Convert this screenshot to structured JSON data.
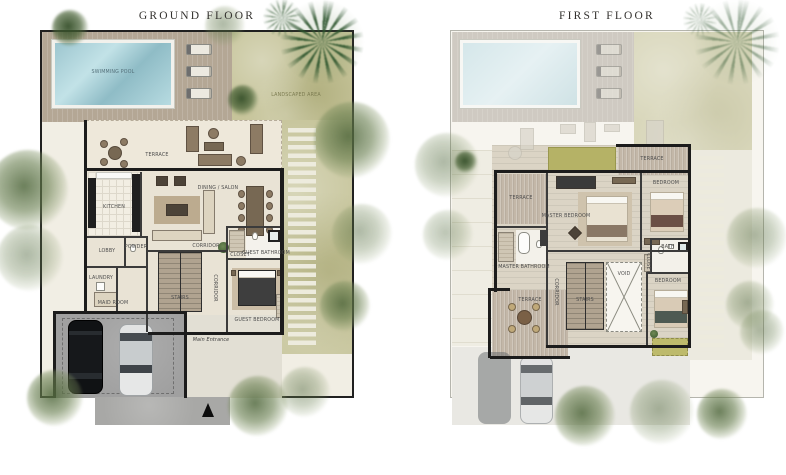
{
  "sheet": {
    "background": "#ffffff"
  },
  "plans": [
    {
      "title": "GROUND FLOOR",
      "labels": {
        "pool": "SWIMMING POOL",
        "landscaped": "LANDSCAPED AREA",
        "terrace": "TERRACE",
        "dining_salon": "DINING / SALON",
        "kitchen": "KITCHEN",
        "lobby": "LOBBY",
        "powder": "POWDER",
        "laundry": "LAUNDRY",
        "maid_room": "MAID ROOM",
        "corridor_a": "CORRIDOR",
        "corridor_b": "CORRIDOR",
        "stairs": "STAIRS",
        "closet": "CLOSET",
        "guest_bathroom": "GUEST BATHROOM",
        "guest_bedroom": "GUEST BEDROOM",
        "main_entrance": "Main Entrance"
      }
    },
    {
      "title": "FIRST FLOOR",
      "labels": {
        "terrace_upper": "TERRACE",
        "terrace_left": "TERRACE",
        "terrace_lower": "TERRACE",
        "master_bedroom": "MASTER BEDROOM",
        "master_bathroom": "MASTER BATHROOM",
        "bedroom_upper": "BEDROOM",
        "bedroom_lower": "BEDROOM",
        "bath": "BATH",
        "closet": "CLOSET",
        "void": "VOID",
        "stairs": "STAIRS",
        "corridor": "CORRIDOR"
      }
    }
  ],
  "colors": {
    "pool_water": "#a9cdd6",
    "wood_deck": "#b3a694",
    "lawn": "#c7c59b",
    "wall": "#1c1c1c",
    "interior_floor": "#e9e3d5",
    "green_roof": "#b5b266",
    "driveway": "#a0a0a0"
  }
}
